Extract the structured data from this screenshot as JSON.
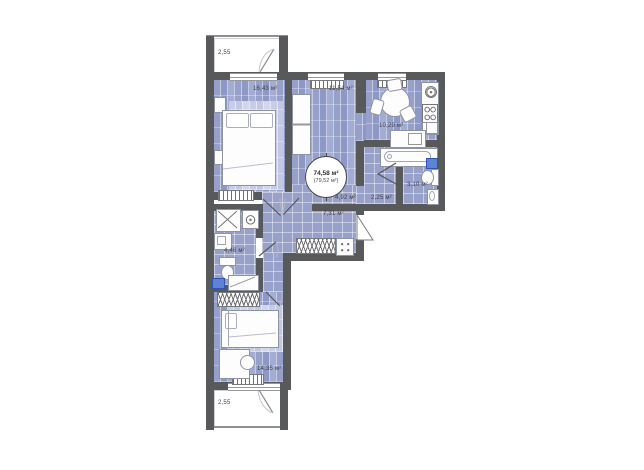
{
  "plan": {
    "title": "apartment-floor-plan",
    "total_area": {
      "primary": "74,58 м²",
      "secondary": "(79,52 м²)"
    },
    "rooms": [
      {
        "name": "bedroom-top",
        "area": "16,43 м²"
      },
      {
        "name": "living-room",
        "area": "11,54 м²"
      },
      {
        "name": "kitchen",
        "area": "10,29 м²"
      },
      {
        "name": "bathroom-right",
        "area": "3,10 м²"
      },
      {
        "name": "lobby",
        "area": "2,25 м²"
      },
      {
        "name": "corridor",
        "area": "4,92 м²"
      },
      {
        "name": "hallway",
        "area": "7,31 м²"
      },
      {
        "name": "bathroom-left",
        "area": "4,46 м²"
      },
      {
        "name": "bedroom-bottom",
        "area": "14,35 м²"
      }
    ],
    "balconies": [
      {
        "name": "balcony-top",
        "area": "2,55"
      },
      {
        "name": "balcony-bottom",
        "area": "2,55"
      }
    ],
    "colors": {
      "wall": "#58595B",
      "floor_plank": "#96A0CB",
      "floor_tile": "#98A1CA",
      "accent_blue": "#5D82D6",
      "background": "#FFFFFF"
    }
  }
}
